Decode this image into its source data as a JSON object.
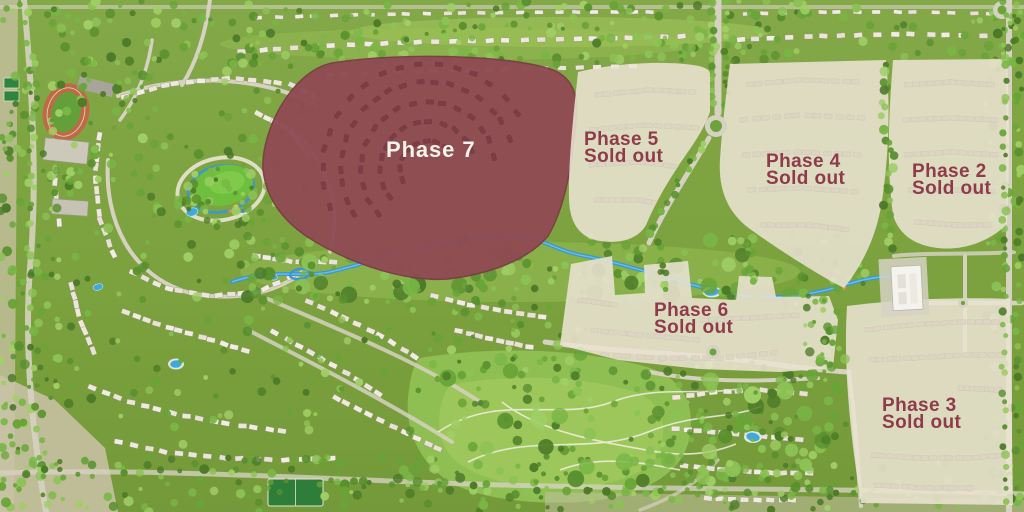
{
  "map": {
    "name": "community-masterplan",
    "colors": {
      "highlight_overlay": "#8f4b53",
      "soldout_overlay": "#eae3d1",
      "soldout_text": "#8e3b4b",
      "highlight_text": "#f7f3eb",
      "landscape_green": "#7ea43f",
      "water_blue": "#3d98cf",
      "road_grey": "#d6d1c1"
    }
  },
  "phases": [
    {
      "key": "phase-7",
      "label": "Phase 7",
      "status": "",
      "state": "highlighted"
    },
    {
      "key": "phase-5",
      "label": "Phase 5",
      "status": "Sold out",
      "state": "sold-out"
    },
    {
      "key": "phase-4",
      "label": "Phase 4",
      "status": "Sold out",
      "state": "sold-out"
    },
    {
      "key": "phase-2",
      "label": "Phase 2",
      "status": "Sold out",
      "state": "sold-out"
    },
    {
      "key": "phase-6",
      "label": "Phase 6",
      "status": "Sold out",
      "state": "sold-out"
    },
    {
      "key": "phase-3",
      "label": "Phase 3",
      "status": "Sold out",
      "state": "sold-out"
    }
  ]
}
